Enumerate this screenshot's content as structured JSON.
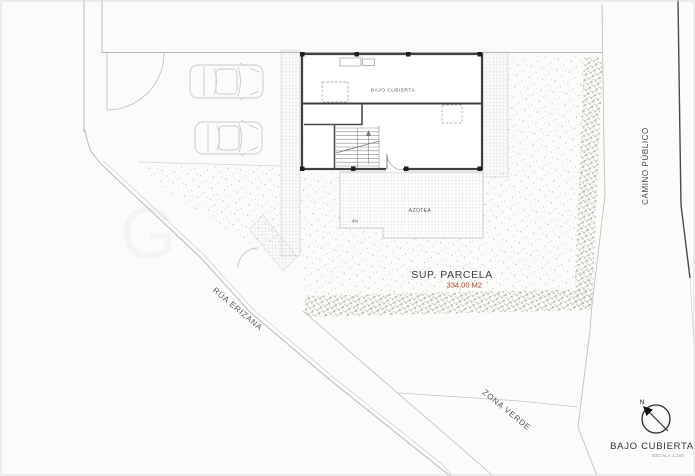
{
  "plan": {
    "building_label": "BAJO CUBIERTA",
    "terrace_label": "AZOTEA",
    "slope_label": "4%",
    "parcel": {
      "label": "SUP. PARCELA",
      "area": "334,00 M2"
    },
    "streets": {
      "west": "RÚA ERIZANA",
      "east": "CAMINO PÚBLICO",
      "south": "ZONA VERDE"
    }
  },
  "title_block": {
    "north_label": "N",
    "title": "BAJO CUBIERTA",
    "scale": "ESCALA 1:100"
  },
  "watermark": "G",
  "colors": {
    "area_accent": "#c0392b",
    "wall": "#3f3f3f",
    "boundary": "#b5b5b5",
    "road_edge": "#4a4a4a"
  }
}
